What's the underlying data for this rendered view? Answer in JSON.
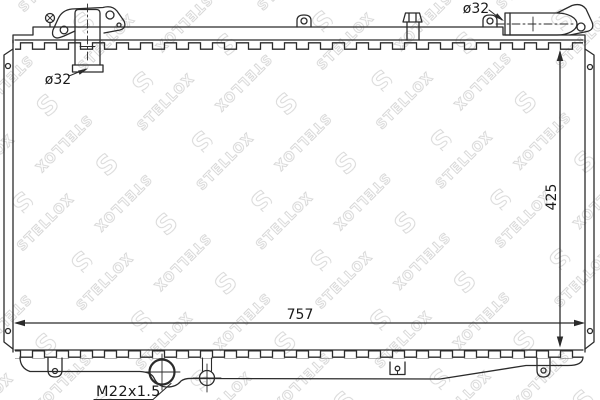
{
  "watermark": {
    "text": "STELLOX",
    "logo_glyph": "S"
  },
  "dimensions": {
    "outlet_pipe_diameter": "ø32",
    "inlet_pipe_diameter": "ø32",
    "core_height_mm": "425",
    "core_width_mm": "757",
    "drain_plug_thread": "M22x1.5"
  },
  "colors": {
    "background": "#ffffff",
    "line": "#2b2b2b",
    "label_text": "#1a1a1a",
    "watermark": "#d6d6d6"
  }
}
